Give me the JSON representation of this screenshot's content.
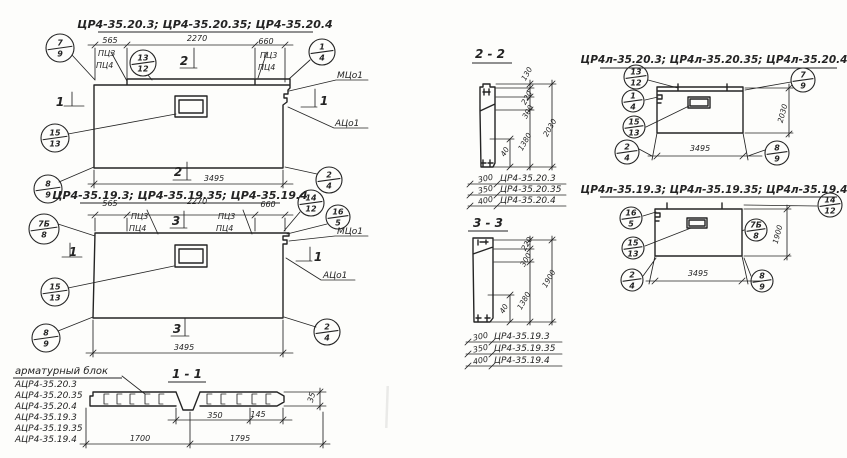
{
  "drawing": {
    "ink": "#242424",
    "paper": "#fdfdfb",
    "texts": [
      {
        "name": "title-series-left-top",
        "s": "ЦР4-35.20.3; ЦР4-35.20.35; ЦР4-35.20.4",
        "x": 205,
        "y": 28,
        "size": 11,
        "bold": true,
        "ul": [
          98,
          32,
          313
        ]
      },
      {
        "name": "title-series-left-bottom",
        "s": "ЦР4-35.19.3; ЦР4-35.19.35; ЦР4-35.19.4",
        "x": 180,
        "y": 199,
        "size": 11,
        "bold": true,
        "ul": [
          80,
          203,
          280
        ]
      },
      {
        "name": "title-series-right-top",
        "s": "ЦР4л-35.20.3; ЦР4л-35.20.35; ЦР4л-35.20.4",
        "x": 714,
        "y": 63,
        "size": 10.5,
        "bold": true,
        "ul": [
          600,
          68,
          837
        ]
      },
      {
        "name": "title-series-right-bottom",
        "s": "ЦР4л-35.19.3; ЦР4л-35.19.35; ЦР4л-35.19.4",
        "x": 714,
        "y": 193,
        "size": 10.5,
        "bold": true,
        "ul": [
          600,
          197,
          837
        ]
      },
      {
        "name": "section-label-2-2",
        "s": "2 - 2",
        "x": 490,
        "y": 58,
        "size": 12,
        "bold": true,
        "ul": [
          472,
          63,
          512
        ]
      },
      {
        "name": "section-label-3-3",
        "s": "3 - 3",
        "x": 488,
        "y": 227,
        "size": 12,
        "bold": true,
        "ul": [
          468,
          231,
          508
        ]
      },
      {
        "name": "section-label-1-1",
        "s": "1 - 1",
        "x": 187,
        "y": 378,
        "size": 12,
        "bold": true,
        "ul": [
          168,
          382,
          206
        ]
      },
      {
        "name": "rebar-block-title",
        "s": "арматурный  блок",
        "x": 15,
        "y": 374,
        "size": 10,
        "anchor": "start",
        "ul": [
          13,
          378,
          122
        ]
      },
      {
        "name": "rebar-list-1",
        "s": "АЦР4-35.20.3",
        "x": 15,
        "y": 387,
        "size": 9,
        "anchor": "start"
      },
      {
        "name": "rebar-list-2",
        "s": "АЦР4-35.20.35",
        "x": 15,
        "y": 398,
        "size": 9,
        "anchor": "start"
      },
      {
        "name": "rebar-list-3",
        "s": "АЦР4-35.20.4",
        "x": 15,
        "y": 409,
        "size": 9,
        "anchor": "start"
      },
      {
        "name": "rebar-list-4",
        "s": "АЦР4-35.19.3",
        "x": 15,
        "y": 420,
        "size": 9,
        "anchor": "start"
      },
      {
        "name": "rebar-list-5",
        "s": "АЦР4-35.19.35",
        "x": 15,
        "y": 431,
        "size": 9,
        "anchor": "start"
      },
      {
        "name": "rebar-list-6",
        "s": "АЦР4-35.19.4",
        "x": 15,
        "y": 442,
        "size": 9,
        "anchor": "start"
      },
      {
        "name": "dim-d1-565",
        "s": "565",
        "x": 110,
        "y": 43,
        "size": 8
      },
      {
        "name": "dim-d1-2270",
        "s": "2270",
        "x": 197,
        "y": 41,
        "size": 8
      },
      {
        "name": "dim-d1-660",
        "s": "660",
        "x": 266,
        "y": 44,
        "size": 8
      },
      {
        "name": "dim-d1-3495",
        "s": "3495",
        "x": 214,
        "y": 181,
        "size": 8
      },
      {
        "name": "label-d1-pc3-left",
        "s": "ПЦ3",
        "x": 98,
        "y": 56,
        "size": 8,
        "anchor": "start"
      },
      {
        "name": "label-d1-pc4-left",
        "s": "ПЦ4",
        "x": 96,
        "y": 68,
        "size": 8,
        "anchor": "start"
      },
      {
        "name": "label-d1-pc3-right",
        "s": "ПЦ3",
        "x": 260,
        "y": 58,
        "size": 8,
        "anchor": "start"
      },
      {
        "name": "label-d1-pc4-right",
        "s": "ПЦ4",
        "x": 258,
        "y": 70,
        "size": 8,
        "anchor": "start"
      },
      {
        "name": "label-d1-mco",
        "s": "МЦо1",
        "x": 337,
        "y": 78,
        "size": 9,
        "anchor": "start"
      },
      {
        "name": "label-d1-aco",
        "s": "АЦо1",
        "x": 335,
        "y": 126,
        "size": 9,
        "anchor": "start"
      },
      {
        "name": "marker-d1-sec2-top",
        "s": "2",
        "x": 184,
        "y": 65,
        "size": 12,
        "bold": true
      },
      {
        "name": "marker-d1-sec2-bottom",
        "s": "2",
        "x": 178,
        "y": 176,
        "size": 12,
        "bold": true
      },
      {
        "name": "marker-d1-sec1-left",
        "s": "1",
        "x": 60,
        "y": 106,
        "size": 12,
        "bold": true
      },
      {
        "name": "marker-d1-sec1-right",
        "s": "1",
        "x": 324,
        "y": 105,
        "size": 12,
        "bold": true
      },
      {
        "name": "dim-d2-565",
        "s": "565",
        "x": 110,
        "y": 206,
        "size": 8
      },
      {
        "name": "dim-d2-2270",
        "s": "2270",
        "x": 197,
        "y": 204,
        "size": 8
      },
      {
        "name": "dim-d2-660",
        "s": "660",
        "x": 268,
        "y": 207,
        "size": 8
      },
      {
        "name": "dim-d2-3495",
        "s": "3495",
        "x": 184,
        "y": 350,
        "size": 8
      },
      {
        "name": "label-d2-pc3-left",
        "s": "ПЦ3",
        "x": 131,
        "y": 219,
        "size": 8,
        "anchor": "start"
      },
      {
        "name": "label-d2-pc4-left",
        "s": "ПЦ4",
        "x": 129,
        "y": 231,
        "size": 8,
        "anchor": "start"
      },
      {
        "name": "label-d2-pc3-right",
        "s": "ПЦ3",
        "x": 218,
        "y": 219,
        "size": 8,
        "anchor": "start"
      },
      {
        "name": "label-d2-pc4-right",
        "s": "ПЦ4",
        "x": 216,
        "y": 231,
        "size": 8,
        "anchor": "start"
      },
      {
        "name": "label-d2-mco",
        "s": "МЦо1",
        "x": 337,
        "y": 234,
        "size": 9,
        "anchor": "start"
      },
      {
        "name": "label-d2-aco",
        "s": "АЦо1",
        "x": 323,
        "y": 278,
        "size": 9,
        "anchor": "start"
      },
      {
        "name": "marker-d2-sec3-top",
        "s": "3",
        "x": 176,
        "y": 225,
        "size": 12,
        "bold": true
      },
      {
        "name": "marker-d2-sec3-bottom",
        "s": "3",
        "x": 177,
        "y": 333,
        "size": 12,
        "bold": true
      },
      {
        "name": "marker-d2-sec1-left",
        "s": "1",
        "x": 73,
        "y": 256,
        "size": 12,
        "bold": true
      },
      {
        "name": "marker-d2-sec1-right",
        "s": "1",
        "x": 318,
        "y": 261,
        "size": 12,
        "bold": true
      },
      {
        "name": "dim-s11-350",
        "s": "350",
        "x": 215,
        "y": 418,
        "size": 8
      },
      {
        "name": "dim-s11-145",
        "s": "145",
        "x": 258,
        "y": 417,
        "size": 8
      },
      {
        "name": "dim-s11-1700",
        "s": "1700",
        "x": 140,
        "y": 441,
        "size": 8
      },
      {
        "name": "dim-s11-1795",
        "s": "1795",
        "x": 240,
        "y": 441,
        "size": 8
      },
      {
        "name": "dim-s11-35",
        "s": "35",
        "x": 314,
        "y": 398,
        "size": 8,
        "rot": -75
      },
      {
        "name": "dim-s22-130",
        "s": "130",
        "x": 529,
        "y": 75,
        "size": 7.5,
        "rot": -60
      },
      {
        "name": "dim-s22-220",
        "s": "220",
        "x": 529,
        "y": 99,
        "size": 7.5,
        "rot": -60
      },
      {
        "name": "dim-s22-300",
        "s": "300",
        "x": 530,
        "y": 113,
        "size": 7.5,
        "rot": -60
      },
      {
        "name": "dim-s22-1380",
        "s": "1380",
        "x": 527,
        "y": 143,
        "size": 7.5,
        "rot": -60
      },
      {
        "name": "dim-s22-2030",
        "s": "2030",
        "x": 552,
        "y": 129,
        "size": 7.5,
        "rot": -60
      },
      {
        "name": "dim-s22-40",
        "s": "40",
        "x": 507,
        "y": 153,
        "size": 7.5,
        "rot": -60
      },
      {
        "name": "table-s22-num-1",
        "s": "300",
        "x": 486,
        "y": 181,
        "size": 8,
        "rot": -12
      },
      {
        "name": "table-s22-num-2",
        "s": "350",
        "x": 486,
        "y": 192,
        "size": 8,
        "rot": -12
      },
      {
        "name": "table-s22-num-3",
        "s": "400",
        "x": 486,
        "y": 203,
        "size": 8,
        "rot": -12
      },
      {
        "name": "table-s22-name-1",
        "s": "ЦР4-35.20.3",
        "x": 500,
        "y": 181,
        "size": 9,
        "anchor": "start"
      },
      {
        "name": "table-s22-name-2",
        "s": "ЦР4-35.20.35",
        "x": 500,
        "y": 192,
        "size": 9,
        "anchor": "start"
      },
      {
        "name": "table-s22-name-3",
        "s": "ЦР4-35.20.4",
        "x": 500,
        "y": 203,
        "size": 9,
        "anchor": "start"
      },
      {
        "name": "dim-s33-220",
        "s": "220",
        "x": 529,
        "y": 245,
        "size": 7.5,
        "rot": -60
      },
      {
        "name": "dim-s33-300",
        "s": "300",
        "x": 528,
        "y": 261,
        "size": 7.5,
        "rot": -60
      },
      {
        "name": "dim-s33-1380",
        "s": "1380",
        "x": 526,
        "y": 302,
        "size": 7.5,
        "rot": -60
      },
      {
        "name": "dim-s33-1900",
        "s": "1900",
        "x": 551,
        "y": 280,
        "size": 7.5,
        "rot": -60
      },
      {
        "name": "dim-s33-40",
        "s": "40",
        "x": 506,
        "y": 310,
        "size": 7.5,
        "rot": -60
      },
      {
        "name": "table-s33-num-1",
        "s": "300",
        "x": 481,
        "y": 339,
        "size": 8,
        "rot": -12
      },
      {
        "name": "table-s33-num-2",
        "s": "350",
        "x": 481,
        "y": 351,
        "size": 8,
        "rot": -12
      },
      {
        "name": "table-s33-num-3",
        "s": "400",
        "x": 481,
        "y": 363,
        "size": 8,
        "rot": -12
      },
      {
        "name": "table-s33-name-1",
        "s": "ЦР4-35.19.3",
        "x": 494,
        "y": 339,
        "size": 9,
        "anchor": "start"
      },
      {
        "name": "table-s33-name-2",
        "s": "ЦР4-35.19.35",
        "x": 494,
        "y": 351,
        "size": 9,
        "anchor": "start"
      },
      {
        "name": "table-s33-name-3",
        "s": "ЦР4-35.19.4",
        "x": 494,
        "y": 363,
        "size": 9,
        "anchor": "start"
      },
      {
        "name": "dim-rd1-3495",
        "s": "3495",
        "x": 700,
        "y": 151,
        "size": 8
      },
      {
        "name": "dim-rd1-2030",
        "s": "2030",
        "x": 785,
        "y": 114,
        "size": 7.5,
        "rot": -75
      },
      {
        "name": "dim-rd2-3495",
        "s": "3495",
        "x": 698,
        "y": 276,
        "size": 8
      },
      {
        "name": "dim-rd2-1900",
        "s": "1900",
        "x": 780,
        "y": 235,
        "size": 7.5,
        "rot": -75
      }
    ],
    "callouts": [
      {
        "name": "callout-7-9-lt",
        "x": 60,
        "y": 48,
        "r": 14,
        "top": "7",
        "bot": "9"
      },
      {
        "name": "callout-13-12-lt",
        "x": 143,
        "y": 63,
        "r": 13,
        "top": "13",
        "bot": "12"
      },
      {
        "name": "callout-1-4-lt",
        "x": 322,
        "y": 52,
        "r": 13,
        "top": "1",
        "bot": "4"
      },
      {
        "name": "callout-15-13-lt",
        "x": 55,
        "y": 138,
        "r": 14,
        "top": "15",
        "bot": "13"
      },
      {
        "name": "callout-8-9-lt",
        "x": 48,
        "y": 189,
        "r": 14,
        "top": "8",
        "bot": "9"
      },
      {
        "name": "callout-2-4-lt",
        "x": 329,
        "y": 180,
        "r": 13,
        "top": "2",
        "bot": "4"
      },
      {
        "name": "callout-7b-8-lb",
        "x": 44,
        "y": 229,
        "r": 15,
        "top": "7Б",
        "bot": "8"
      },
      {
        "name": "callout-14-12-lb",
        "x": 311,
        "y": 203,
        "r": 13,
        "top": "14",
        "bot": "12"
      },
      {
        "name": "callout-16-5-lb",
        "x": 338,
        "y": 217,
        "r": 12,
        "top": "16",
        "bot": "5"
      },
      {
        "name": "callout-15-13-lb",
        "x": 55,
        "y": 292,
        "r": 14,
        "top": "15",
        "bot": "13"
      },
      {
        "name": "callout-8-9-lb",
        "x": 46,
        "y": 338,
        "r": 14,
        "top": "8",
        "bot": "9"
      },
      {
        "name": "callout-2-4-lb",
        "x": 327,
        "y": 332,
        "r": 13,
        "top": "2",
        "bot": "4"
      },
      {
        "name": "callout-13-12-rt",
        "x": 636,
        "y": 77,
        "r": 12,
        "top": "13",
        "bot": "12"
      },
      {
        "name": "callout-7-9-rt",
        "x": 803,
        "y": 80,
        "r": 12,
        "top": "7",
        "bot": "9"
      },
      {
        "name": "callout-1-4-rt",
        "x": 633,
        "y": 101,
        "r": 11,
        "top": "1",
        "bot": "4"
      },
      {
        "name": "callout-15-13-rt",
        "x": 634,
        "y": 127,
        "r": 11,
        "top": "15",
        "bot": "13"
      },
      {
        "name": "callout-2-4-rt",
        "x": 627,
        "y": 152,
        "r": 12,
        "top": "2",
        "bot": "4"
      },
      {
        "name": "callout-8-9-rt",
        "x": 777,
        "y": 153,
        "r": 12,
        "top": "8",
        "bot": "9"
      },
      {
        "name": "callout-16-5-rb",
        "x": 631,
        "y": 218,
        "r": 11,
        "top": "16",
        "bot": "5"
      },
      {
        "name": "callout-14-12-rb",
        "x": 830,
        "y": 205,
        "r": 12,
        "top": "14",
        "bot": "12"
      },
      {
        "name": "callout-7b-8-rb",
        "x": 756,
        "y": 230,
        "r": 11,
        "top": "7Б",
        "bot": "8"
      },
      {
        "name": "callout-15-13-rb",
        "x": 633,
        "y": 248,
        "r": 11,
        "top": "15",
        "bot": "13"
      },
      {
        "name": "callout-2-4-rb",
        "x": 632,
        "y": 280,
        "r": 11,
        "top": "2",
        "bot": "4"
      },
      {
        "name": "callout-8-9-rb",
        "x": 762,
        "y": 281,
        "r": 11,
        "top": "8",
        "bot": "9"
      }
    ]
  }
}
